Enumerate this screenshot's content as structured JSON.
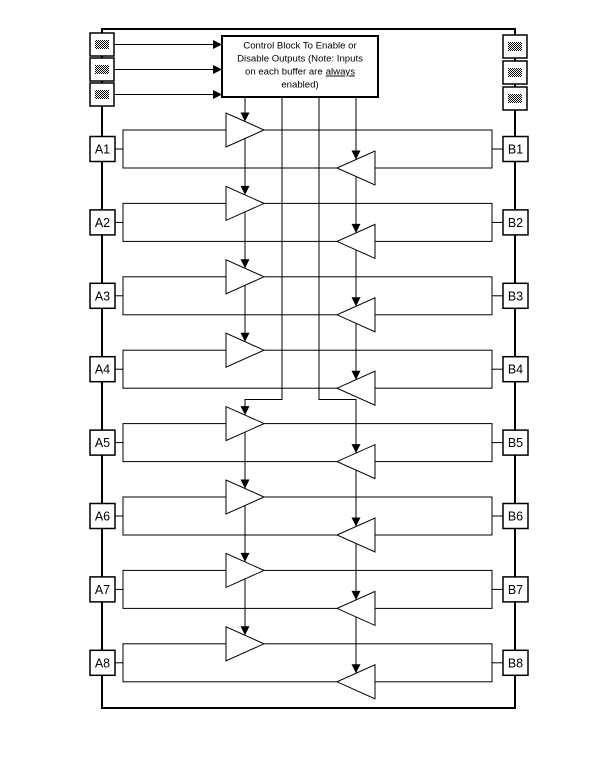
{
  "diagram": {
    "kind": "octal-bidirectional-buffer-block-diagram",
    "rows": 8
  },
  "control_block": {
    "line1": "Control Block To Enable or",
    "line2": "Disable Outputs (Note: Inputs",
    "line3_prefix": "on each buffer are",
    "line3_underlined": "always",
    "line4": "enabled)"
  },
  "pins_left": [
    "A1",
    "A2",
    "A3",
    "A4",
    "A5",
    "A6",
    "A7",
    "A8"
  ],
  "pins_right": [
    "B1",
    "B2",
    "B3",
    "B4",
    "B5",
    "B6",
    "B7",
    "B8"
  ],
  "control_input_pads": {
    "left_count": 3,
    "right_count": 3,
    "icon": "hatched-pad-icon"
  },
  "buffers": {
    "a_to_b": "right-pointing-buffer",
    "b_to_a": "left-pointing-buffer"
  },
  "colors": {
    "line": "#000000",
    "background": "#ffffff"
  }
}
